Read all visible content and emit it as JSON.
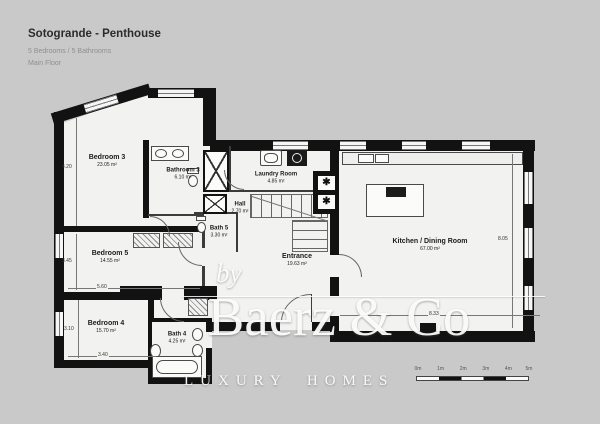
{
  "header": {
    "title": "Sotogrande - Penthouse",
    "subtitle": "5 Bedrooms / 5 Bathrooms",
    "floor_label": "Main Floor"
  },
  "rooms": [
    {
      "name": "Bedroom 3",
      "area": "23.05 m²"
    },
    {
      "name": "Bathroom 3",
      "area": "6.10 m²"
    },
    {
      "name": "Laundry Room",
      "area": "4.85 m²"
    },
    {
      "name": "Hall",
      "area": "2.70 m²"
    },
    {
      "name": "Bath 5",
      "area": "3.30 m²"
    },
    {
      "name": "Bedroom 5",
      "area": "14.55 m²"
    },
    {
      "name": "Entrance",
      "area": "19.63 m²"
    },
    {
      "name": "Kitchen / Dining Room",
      "area": "67.00 m²"
    },
    {
      "name": "Bedroom 4",
      "area": "15.70 m²"
    },
    {
      "name": "Bath 4",
      "area": "4.25 m²"
    }
  ],
  "dimensions": [
    "4.20",
    "3.45",
    "3.10",
    "5.60",
    "3.40",
    "8.33",
    "8.05"
  ],
  "watermark": {
    "prefix": "by",
    "brand": "Baerz & Co",
    "tagline": "LUXURY HOMES"
  },
  "scale_bar": {
    "labels": [
      "0m",
      "1m",
      "2m",
      "3m",
      "4m",
      "5m"
    ]
  },
  "symbols": {
    "shaft_marker": "✱"
  },
  "colors": {
    "background": "#c9c9c9",
    "room_fill": "#f2f2f0",
    "wall": "#121212",
    "line": "#666666",
    "title_text": "#2b2b2b",
    "muted_text": "#8f8f8f",
    "watermark": "#ffffff"
  }
}
